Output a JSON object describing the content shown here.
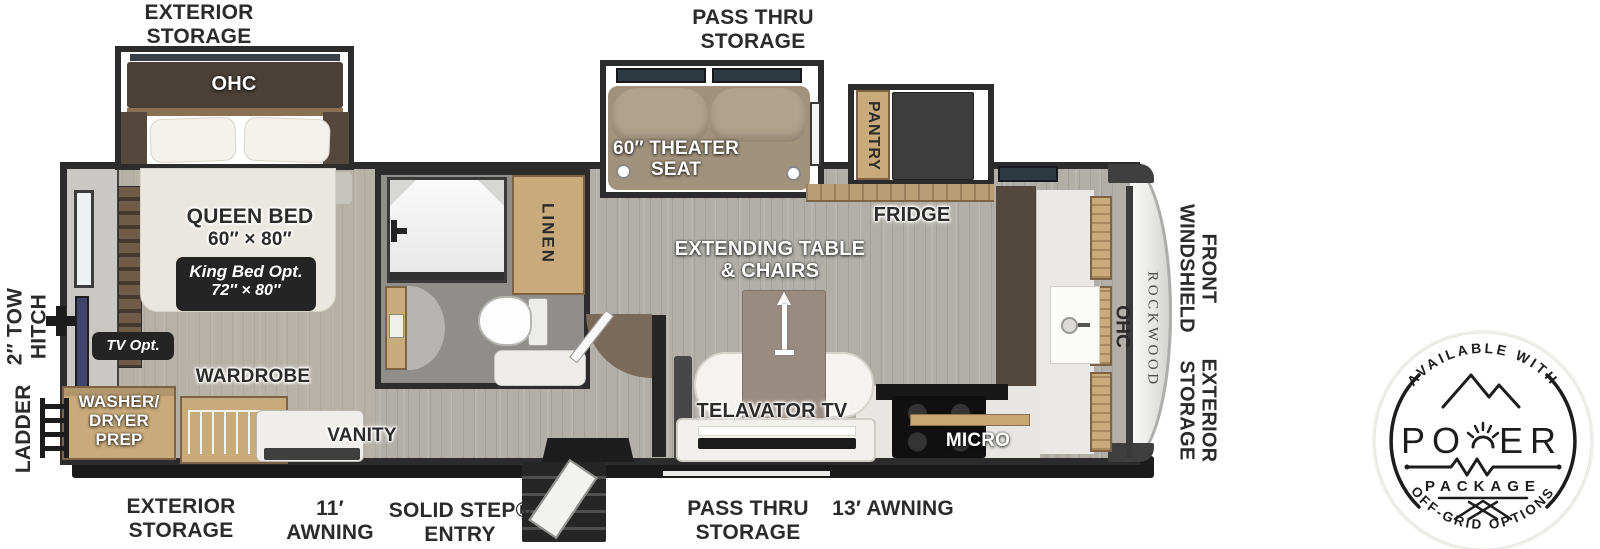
{
  "labels": {
    "exterior_storage_top": {
      "l1": "EXTERIOR",
      "l2": "STORAGE"
    },
    "pass_thru_top": {
      "l1": "PASS THRU",
      "l2": "STORAGE"
    },
    "ohc_bedroom": "OHC",
    "queen_bed": {
      "l1": "QUEEN BED",
      "l2": "60″ × 80″"
    },
    "king_bed_opt": {
      "l1": "King Bed Opt.",
      "l2": "72″ × 80″"
    },
    "tv_opt": "TV Opt.",
    "wardrobe": "WARDROBE",
    "washer_dryer": {
      "l1": "WASHER/",
      "l2": "DRYER",
      "l3": "PREP"
    },
    "vanity": "VANITY",
    "linen": "LINEN",
    "theater_seat": {
      "l1": "60″ THEATER",
      "l2": "SEAT"
    },
    "pantry": "PANTRY",
    "fridge": "FRIDGE",
    "extending_table": {
      "l1": "EXTENDING TABLE",
      "l2": "& CHAIRS"
    },
    "telavator_tv": "TELAVATOR TV",
    "micro": "MICRO",
    "ohc_front": "OHC",
    "brand": "ROCKWOOD",
    "front_windshield": {
      "l1": "FRONT",
      "l2": "WINDSHIELD"
    },
    "exterior_storage_right": {
      "l1": "EXTERIOR",
      "l2": "STORAGE"
    },
    "tow_hitch": {
      "l1": "2″ TOW",
      "l2": "HITCH"
    },
    "ladder": "LADDER",
    "exterior_storage_bottom": {
      "l1": "EXTERIOR",
      "l2": "STORAGE"
    },
    "awning_11": {
      "l1": "11′",
      "l2": "AWNING"
    },
    "solid_step": {
      "l1": "SOLID STEP®",
      "l2": "ENTRY"
    },
    "pass_thru_bottom": {
      "l1": "PASS THRU",
      "l2": "STORAGE"
    },
    "awning_13": "13′ AWNING"
  },
  "badge": {
    "top_arc": "AVAILABLE WITH",
    "power_prefix": "PO",
    "power_suffix": "ER",
    "package": "PACKAGE",
    "bottom_arc": "OFF-GRID OPTIONS"
  },
  "colors": {
    "wall": "#2c2c2c",
    "floor": "#b1afa8",
    "wood": "#c9aa7b",
    "bed": "#eae7e0",
    "theater_seat": "#a79882",
    "callout_box": "#242424",
    "badge_ink": "#1d1d1d"
  }
}
